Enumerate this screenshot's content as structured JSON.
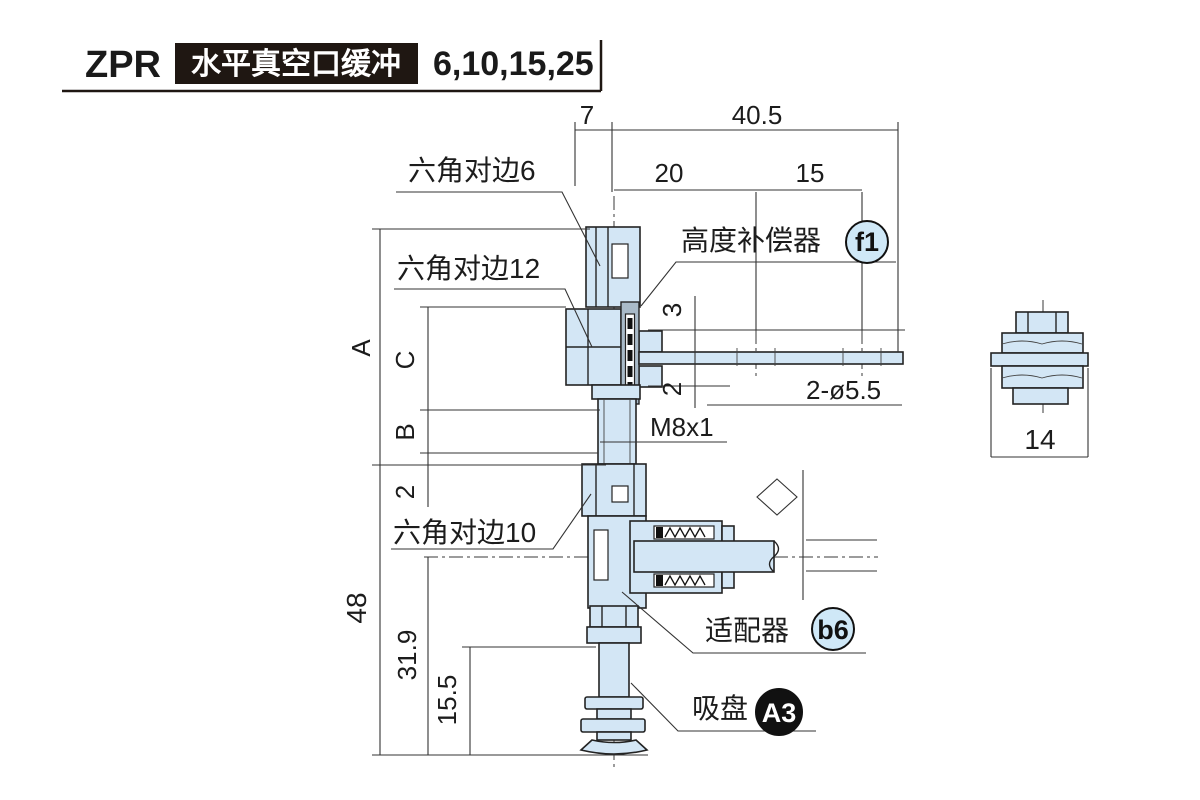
{
  "header": {
    "series": "ZPR",
    "title": "水平真空口缓冲",
    "sizes": "6,10,15,25"
  },
  "dimensions": {
    "top_offset": "7",
    "top_width": "40.5",
    "hole_pitch_1": "20",
    "hole_pitch_2": "15",
    "travel_up": "3",
    "travel_down": "2",
    "holes": "2-ø5.5",
    "thread": "M8x1",
    "dim_a": "A",
    "dim_c": "C",
    "dim_b": "B",
    "lower_gap": "2",
    "overall_height": "48",
    "pad_height": "31.9",
    "pad_lower": "15.5",
    "side_width": "14"
  },
  "labels": {
    "hex_flats_6": "六角对边6",
    "hex_flats_12": "六角对边12",
    "hex_flats_10": "六角对边10",
    "height_compensator": "高度补偿器",
    "height_compensator_badge": "f1",
    "adapter": "适配器",
    "adapter_badge": "b6",
    "suction_pad": "吸盘",
    "suction_pad_badge": "A3"
  },
  "colors": {
    "part_fill": "#d3e6f5",
    "plate_fill": "#a9bac8",
    "outline": "#232323",
    "header_box": "#1f1712",
    "badge_fill": "#cfe8f7",
    "badge_dark": "#111111"
  }
}
